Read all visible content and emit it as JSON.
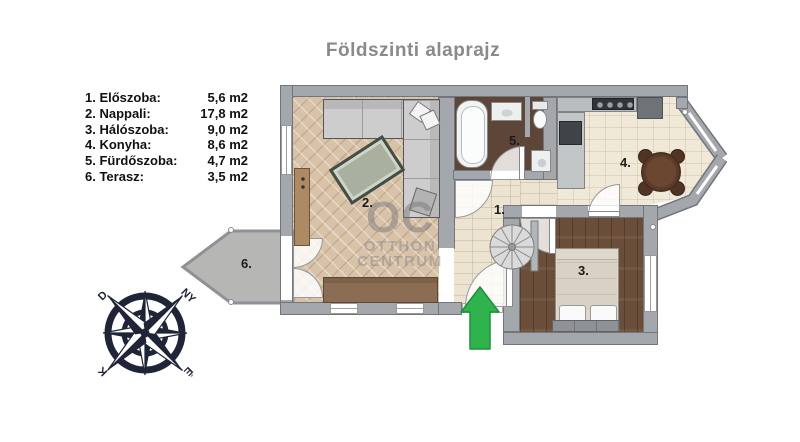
{
  "title": "Földszinti alaprajz",
  "legend": [
    {
      "label": "1. Előszoba:",
      "value": "5,6 m2"
    },
    {
      "label": "2. Nappali:",
      "value": "17,8 m2"
    },
    {
      "label": "3. Hálószoba:",
      "value": "9,0 m2"
    },
    {
      "label": "4. Konyha:",
      "value": "8,6 m2"
    },
    {
      "label": "5. Fürdőszoba:",
      "value": "4,7 m2"
    },
    {
      "label": "6. Terasz:",
      "value": "3,5 m2"
    }
  ],
  "room_labels": {
    "hall": "1.",
    "living": "2.",
    "bedroom": "3.",
    "kitchen": "4.",
    "bathroom": "5.",
    "terrace": "6."
  },
  "watermark": {
    "abbr": "OC",
    "line1": "OTTHON",
    "line2": "CENTRUM"
  },
  "compass": {
    "top_left": "D",
    "top_right": "NY",
    "bottom_left": "K",
    "bottom_right": "É"
  },
  "colors": {
    "entrance_arrow": "#2fb34d",
    "compass": "#1f2537",
    "living_floor": "#d8c2a8",
    "hall_floor": "#ece3d1",
    "bedroom_floor": "#6a4e39",
    "bathroom_floor": "#5d4637",
    "kitchen_floor": "#f0e9d8",
    "terrace": "#b6b6b4",
    "walls": "#a4a7ac",
    "title_text": "#8a8a8a"
  }
}
